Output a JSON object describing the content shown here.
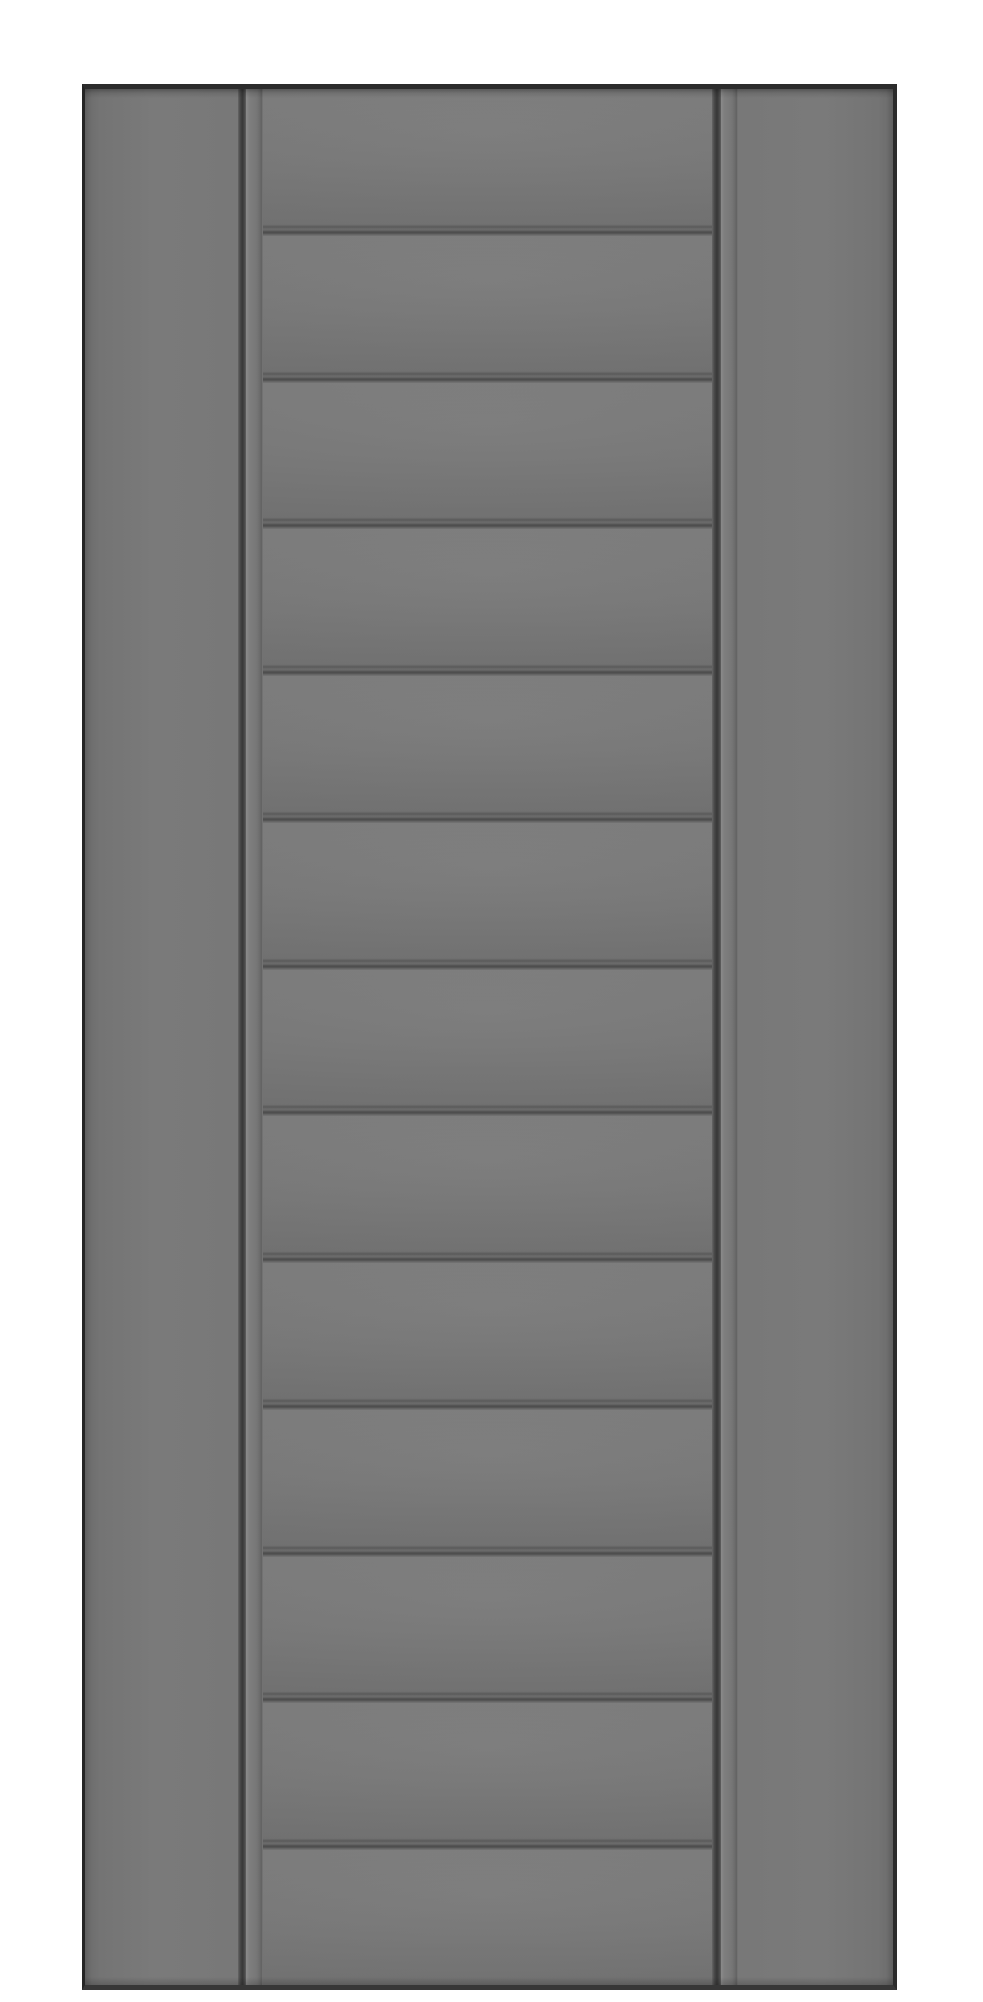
{
  "page": {
    "background_color": "#ffffff",
    "width_px": 983,
    "height_px": 2002
  },
  "door": {
    "kind": "gray-flush-door-with-horizontal-grooved-center",
    "face_color": "#787878",
    "stile_shadow_color": "#6b6b6b",
    "horizontal_groove_dark_color": "#4b4b4b",
    "vertical_groove_dark_color": "#373737",
    "edge_line_colors": {
      "top": "#2c2c2c",
      "bottom": "#373737",
      "left": "#242424",
      "right": "#2b2b2b"
    },
    "center_panel_count": 13,
    "horizontal_groove_count": 12,
    "vertical_groove_count": 2,
    "strip_highlight_color": "#8a8a8a",
    "strip_score_line_color": "#5f5f5f"
  }
}
